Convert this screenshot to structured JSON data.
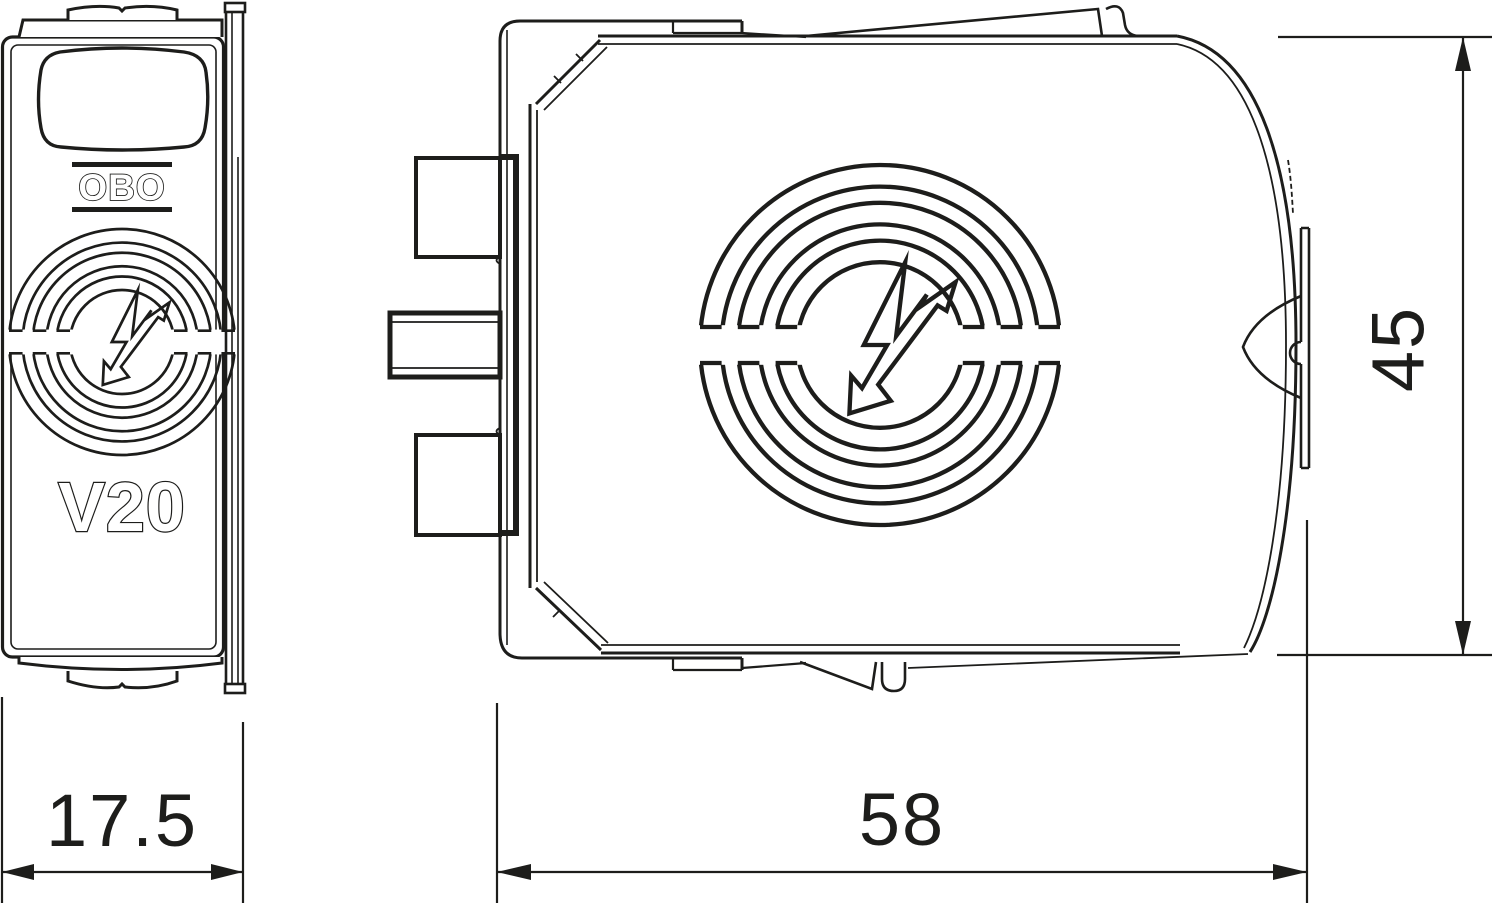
{
  "drawing": {
    "type": "technical-dimension-drawing",
    "product": "OBO V20 surge protection plug, two-view dimensional drawing",
    "labels": {
      "brand": "OBO",
      "model": "V20"
    },
    "dimensions": {
      "side_view_width": "17.5",
      "front_view_width": "58",
      "front_view_height": "45"
    },
    "icons": [
      "surge-lightning-ring-icon"
    ],
    "colors": {
      "line": "#1d1d1b",
      "background": "#ffffff"
    }
  }
}
